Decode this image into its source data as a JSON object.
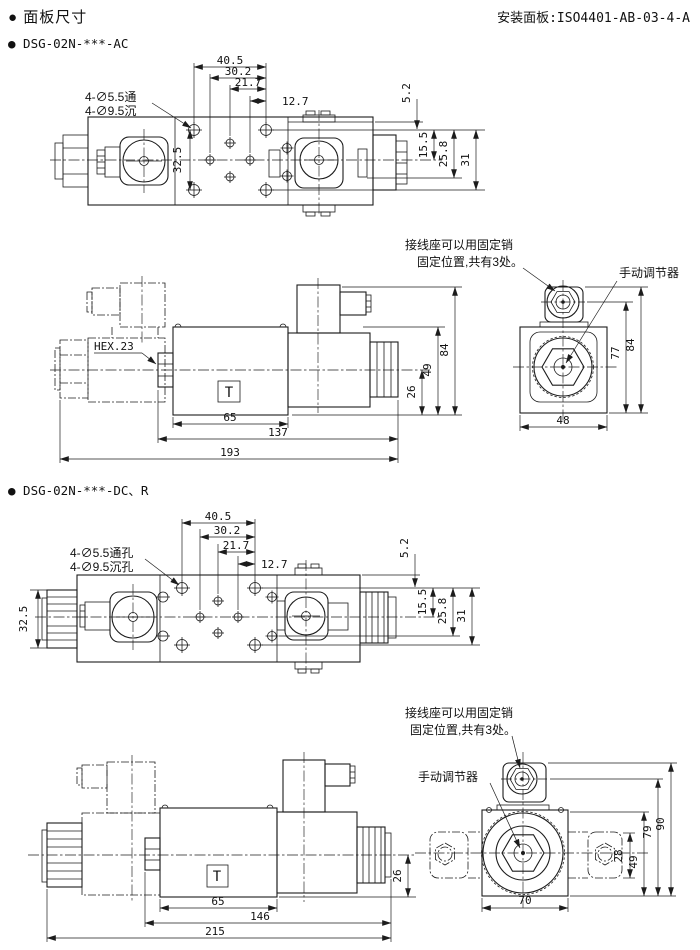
{
  "header": {
    "title": "● 面板尺寸",
    "mounting_panel": "安装面板:ISO4401-AB-03-4-A"
  },
  "sections": {
    "ac": {
      "label": "● DSG-02N-***-AC",
      "plan": {
        "hole_note1": "4-∅5.5通",
        "hole_note2": "4-∅9.5沉",
        "dims": {
          "w1": "40.5",
          "w2": "30.2",
          "w3": "21.7",
          "w4": "12.7",
          "r1": "5.2",
          "r2": "15.5",
          "r3": "25.8",
          "r4": "31",
          "left": "32.5"
        }
      },
      "side": {
        "hex_note": "HEX.23",
        "port": "T",
        "dims": {
          "body_w": "65",
          "mid_w": "137",
          "overall_w": "193",
          "c_bot": "26",
          "body_h": "49",
          "overall_h": "84"
        }
      },
      "end": {
        "pin_note1": "接线座可以用固定销",
        "pin_note2": "固定位置,共有3处。",
        "adjuster": "手动调节器",
        "dims": {
          "w": "48",
          "h1": "77",
          "h2": "84"
        }
      }
    },
    "dc": {
      "label": "● DSG-02N-***-DC、R",
      "plan": {
        "hole_note1": "4-∅5.5通孔",
        "hole_note2": "4-∅9.5沉孔",
        "dims": {
          "w1": "40.5",
          "w2": "30.2",
          "w3": "21.7",
          "w4": "12.7",
          "r1": "5.2",
          "r2": "15.5",
          "r3": "25.8",
          "r4": "31",
          "left": "32.5"
        }
      },
      "side": {
        "port": "T",
        "dims": {
          "body_w": "65",
          "mid_w": "146",
          "overall_w": "215",
          "c_bot": "26"
        }
      },
      "end": {
        "pin_note1": "接线座可以用固定销",
        "pin_note2": "固定位置,共有3处。",
        "adjuster": "手动调节器",
        "dims": {
          "w": "70",
          "h1": "28",
          "h2": "49",
          "h3": "79",
          "h4": "90"
        }
      }
    }
  }
}
